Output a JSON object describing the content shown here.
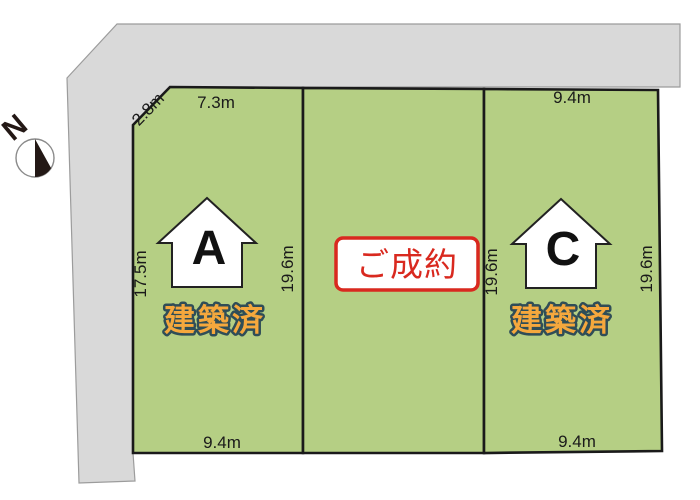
{
  "compass": {
    "label": "N"
  },
  "colors": {
    "plot_green": "#b5cf84",
    "road_gray": "#d9d9d9",
    "border_black": "#1a1a1a",
    "sold_red": "#d9291f",
    "built_orange": "#f5a83d",
    "built_outline": "#2f4d57"
  },
  "plots": {
    "a": {
      "letter": "A",
      "status": "建築済",
      "dim_corner": "2.8m",
      "dim_top": "7.3m",
      "dim_left": "17.5m",
      "dim_right": "19.6m",
      "dim_bottom": "9.4m"
    },
    "b": {
      "status": "ご成約"
    },
    "c": {
      "letter": "C",
      "status": "建築済",
      "dim_top": "9.4m",
      "dim_left": "19.6m",
      "dim_right": "19.6m",
      "dim_bottom": "9.4m"
    }
  }
}
